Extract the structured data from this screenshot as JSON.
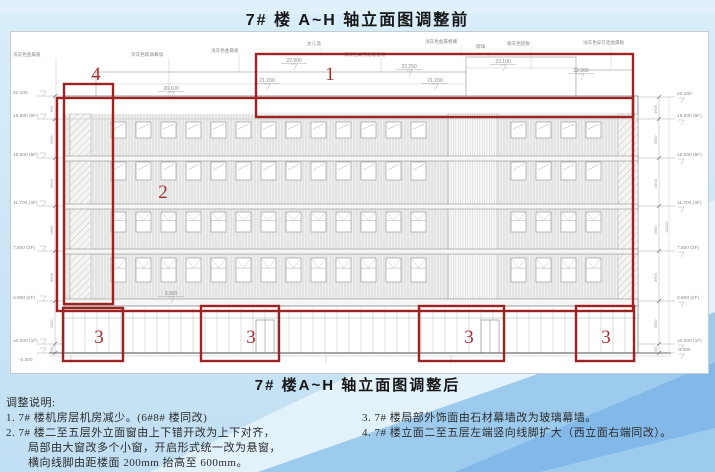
{
  "colors": {
    "accent_red": "#9b2423",
    "bg_blue": "#cbe5f6",
    "swoosh_light": "#e8f4fc",
    "swoosh_mid": "#9ccbee",
    "swoosh_deep": "#7eb6e6",
    "line_gray": "#8f8f8f"
  },
  "titles": {
    "before": "7# 楼 A~H 轴立面图调整前",
    "after": "7# 楼A~H 轴立面图调整后"
  },
  "notes": {
    "heading": "调整说明:",
    "left": [
      "1.  7#  楼机房层机房减少。(6#8#  楼同改)",
      "2.  7#  楼二至五层外立面窗由上下错开改为上下对齐，",
      "局部由大窗改多个小窗，开启形式统一改为悬窗，",
      "横向线脚由距楼面 200mm  抬高至  600mm。"
    ],
    "right": [
      "3.   7#  楼局部外饰面由石材幕墙改为玻璃幕墙。",
      "4.   7#  楼立面二至五层左端竖向线脚扩大（西立面右端同改）。"
    ]
  },
  "callouts": {
    "c1": "1",
    "c2": "2",
    "c3": "3",
    "c4": "4"
  },
  "elevations_left": [
    "20.100",
    "19.500 (6F)",
    "15.600 (5F)",
    "11.700 (4F)",
    "7.800 (3F)",
    "3.900 (2F)",
    "±0.000 (1F)",
    "-0.300"
  ],
  "elevations_right": [
    "23.100",
    "19.500 (6F)",
    "15.600 (5F)",
    "11.700 (4F)",
    "7.800 (3F)",
    "3.900 (2F)",
    "±0.000 (1F)",
    "-0.300"
  ],
  "dims_left": [
    "600",
    "3900",
    "3900",
    "3900",
    "3900",
    "3900",
    "300"
  ],
  "dims_right": [
    "3600",
    "3900",
    "3900",
    "3900",
    "3900",
    "3900",
    "300"
  ],
  "dim_total_right": "20100",
  "roof_marks": [
    "22.900",
    "21.200",
    "22.250",
    "21.200",
    "23.100",
    "22.300"
  ],
  "facade_marks": [
    "20.100",
    "3.900"
  ],
  "material_labels": [
    "浅灰色金属板",
    "深灰色玻璃幕墙",
    "浅灰色金属板",
    "女儿墙",
    "银灰色穿孔铝吸音板",
    "浅灰色金属格栅",
    "玻璃",
    "银灰色铝板",
    "浅灰色穿孔铝金属板"
  ]
}
